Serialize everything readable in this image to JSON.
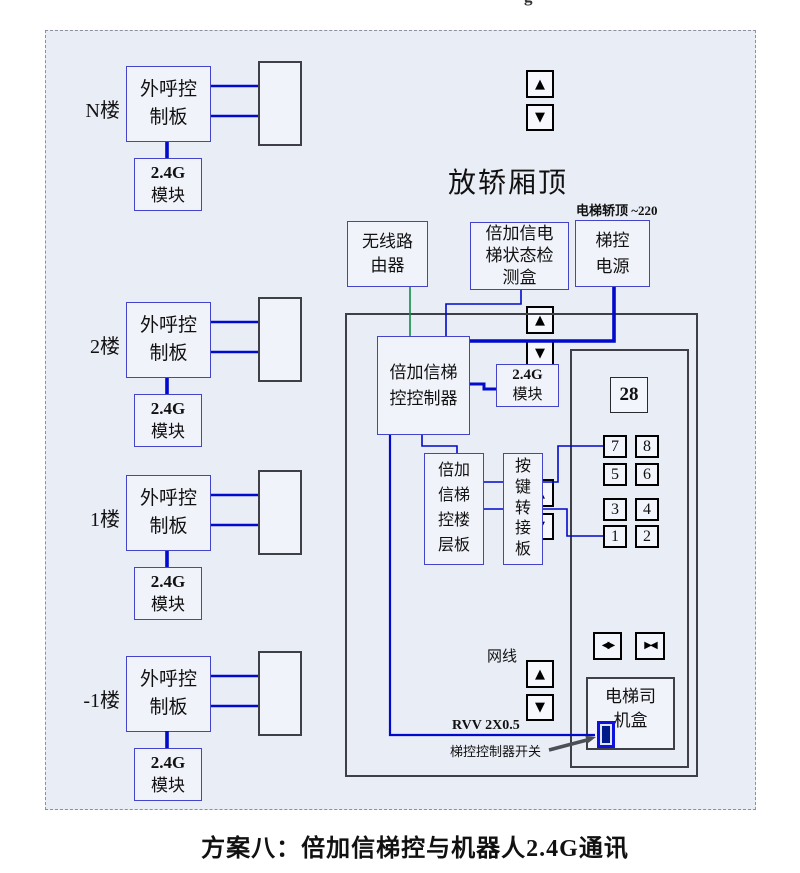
{
  "colors": {
    "canvas_bg": "#ffffff",
    "panel_bg": "#e9edf6",
    "box_bg": "#f1f3fa",
    "box_border_blue": "#4444cb",
    "box_border_gray": "#3f3f48",
    "line_blue": "#0009cc",
    "line_green": "#128c46",
    "arrow_gray": "#4c4f55",
    "switch_blue": "#0f12dd",
    "switch_fill": "#001a8c",
    "text_color": "#111111"
  },
  "top_clipped_text": "g",
  "icons": {
    "up": "▲",
    "down": "▼",
    "door_open": "◀▶",
    "door_close": "▶◀"
  },
  "module_label": {
    "line1": "2.4G",
    "line2": "模块"
  },
  "floors": [
    {
      "label": "N楼",
      "board": "外呼控制板"
    },
    {
      "label": "2楼",
      "board": "外呼控制板"
    },
    {
      "label": "1楼",
      "board": "外呼控制板"
    },
    {
      "label": "-1楼",
      "board": "外呼控制板"
    }
  ],
  "car_top": {
    "title": "放轿厢顶",
    "power_note": "电梯轿顶 ~220",
    "router": "无线路由器",
    "detector": "倍加信电梯状态检测盒",
    "power_supply": "梯控电源",
    "controller": "倍加信梯控控制器",
    "module_line1": "2.4G",
    "module_line2": "模块",
    "floor_board": "倍加信梯控楼层板",
    "key_adapter": "按键转接板",
    "display_value": "28",
    "floor_buttons": [
      "7",
      "8",
      "5",
      "6",
      "3",
      "4",
      "1",
      "2"
    ],
    "driver_box": "电梯司机盒",
    "net_cable_label": "网线",
    "rvv_label": "RVV 2X0.5",
    "switch_label": "梯控控制器开关"
  },
  "caption": "方案八：倍加信梯控与机器人2.4G通讯"
}
